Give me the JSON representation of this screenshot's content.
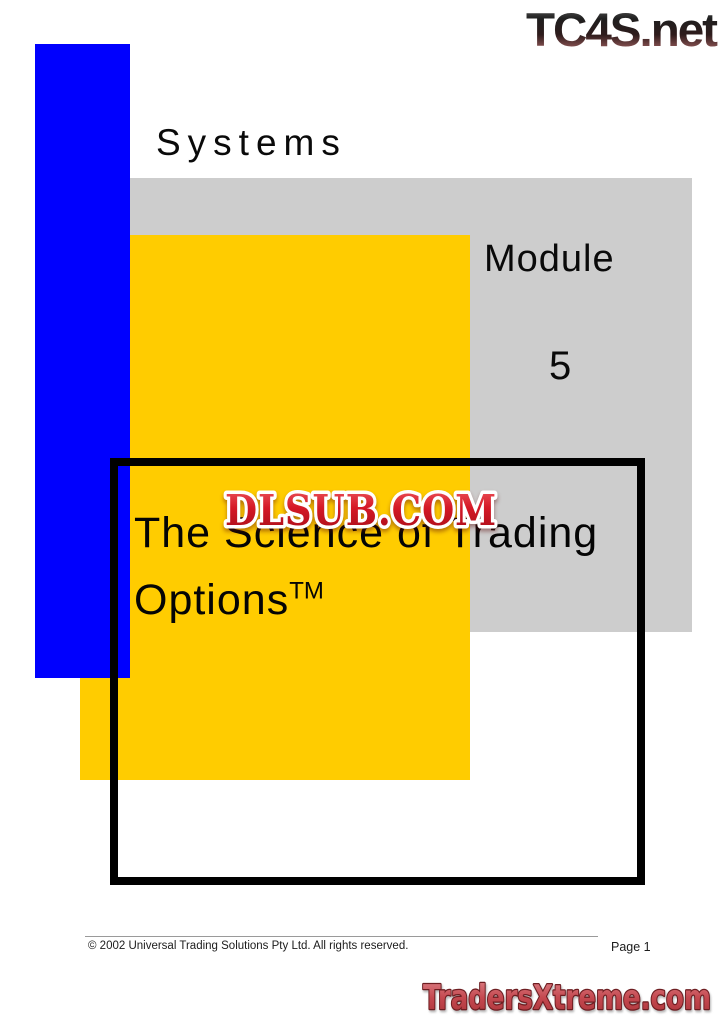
{
  "header": {
    "site_logo": "TC4S.net"
  },
  "cover": {
    "kicker": "Systems",
    "module_label": "Module",
    "module_number": "5",
    "title_line1": "The Science of Trading",
    "title_line2": "Options",
    "trademark_superscript": "TM"
  },
  "watermark": {
    "site_logo": "DLSUB.COM"
  },
  "footer": {
    "copyright": "© 2002 Universal Trading Solutions Pty Ltd. All rights reserved.",
    "page_number": "Page 1",
    "site_logo": "TradersXtreme.com"
  },
  "colors": {
    "accent-blue": "#0000fe",
    "accent-yellow": "#ffcc00",
    "panel-gray": "#cdcdcd",
    "frame-black": "#000000",
    "watermark-red": "#c81420",
    "logo-red": "#c05056"
  }
}
